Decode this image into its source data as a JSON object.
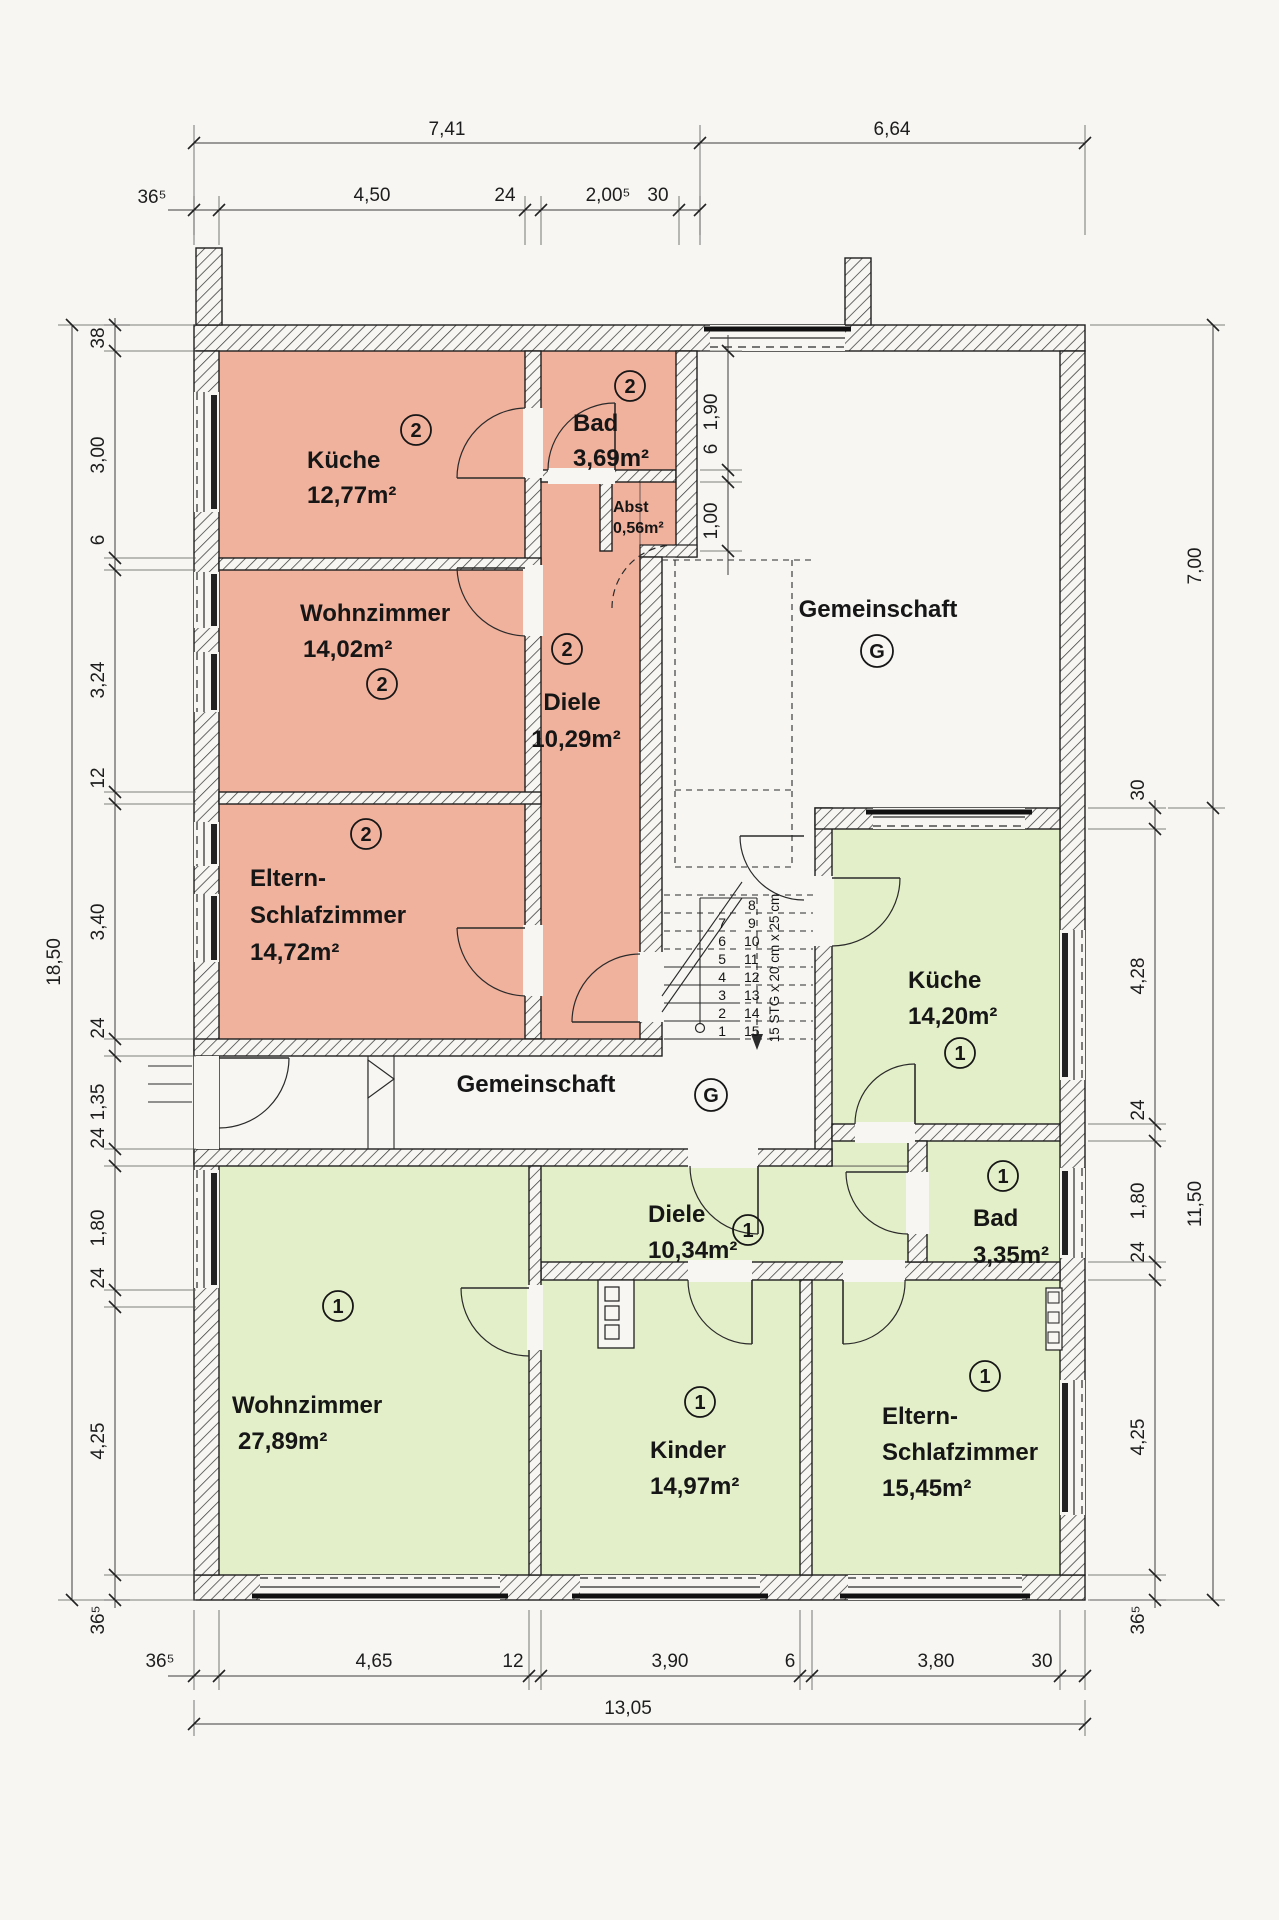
{
  "plan": {
    "apartment2": {
      "badge": "2",
      "kueche": {
        "name": "Küche",
        "area": "12,77m²"
      },
      "bad": {
        "name": "Bad",
        "area": "3,69m²"
      },
      "abst": {
        "name": "Abst",
        "area": "0,56m²"
      },
      "wohnzimmer": {
        "name": "Wohnzimmer",
        "area": "14,02m²"
      },
      "diele": {
        "name": "Diele",
        "area": "10,29m²"
      },
      "eltern": {
        "name1": "Eltern-",
        "name2": "Schlafzimmer",
        "area": "14,72m²"
      }
    },
    "apartment1": {
      "badge": "1",
      "kueche": {
        "name": "Küche",
        "area": "14,20m²"
      },
      "diele": {
        "name": "Diele",
        "area": "10,34m²"
      },
      "bad": {
        "name": "Bad",
        "area": "3,35m²"
      },
      "wohnzimmer": {
        "name": "Wohnzimmer",
        "area": "27,89m²"
      },
      "kinder": {
        "name": "Kinder",
        "area": "14,97m²"
      },
      "eltern": {
        "name1": "Eltern-",
        "name2": "Schlafzimmer",
        "area": "15,45m²"
      }
    },
    "common_upper": {
      "label": "Gemeinschaft",
      "badge": "G"
    },
    "common_middle": {
      "label": "Gemeinschaft",
      "badge": "G"
    },
    "stair": {
      "note": "15 STG x 20 cm x 25 cm",
      "steps": [
        "1",
        "2",
        "3",
        "4",
        "5",
        "6",
        "7",
        "8",
        "9",
        "10",
        "11",
        "12",
        "13",
        "14",
        "15"
      ]
    },
    "dimensions": {
      "top_overall": [
        "7,41",
        "6,64"
      ],
      "top_chain": [
        "36⁵",
        "4,50",
        "24",
        "2,00⁵",
        "30"
      ],
      "left_overall": "18,50",
      "left_chain": [
        "38",
        "3,00",
        "6",
        "3,24",
        "12",
        "3,40",
        "24",
        "1,35",
        "24",
        "1,80",
        "24",
        "4,25",
        "36⁵"
      ],
      "right_upper": "7,00",
      "right_lower": "11,50",
      "right_chain": [
        "30",
        "4,28",
        "24",
        "1,80",
        "24",
        "4,25",
        "36⁵"
      ],
      "bad2_chain": [
        "1,90",
        "6",
        "1,00"
      ],
      "bottom_chain": [
        "36⁵",
        "4,65",
        "12",
        "3,90",
        "6",
        "3,80",
        "30"
      ],
      "bottom_overall": "13,05"
    },
    "colors": {
      "apartment2": "#f0b19d",
      "apartment1": "#e3efc8",
      "paper": "#f7f6f2",
      "line": "#2a2a2a"
    }
  }
}
